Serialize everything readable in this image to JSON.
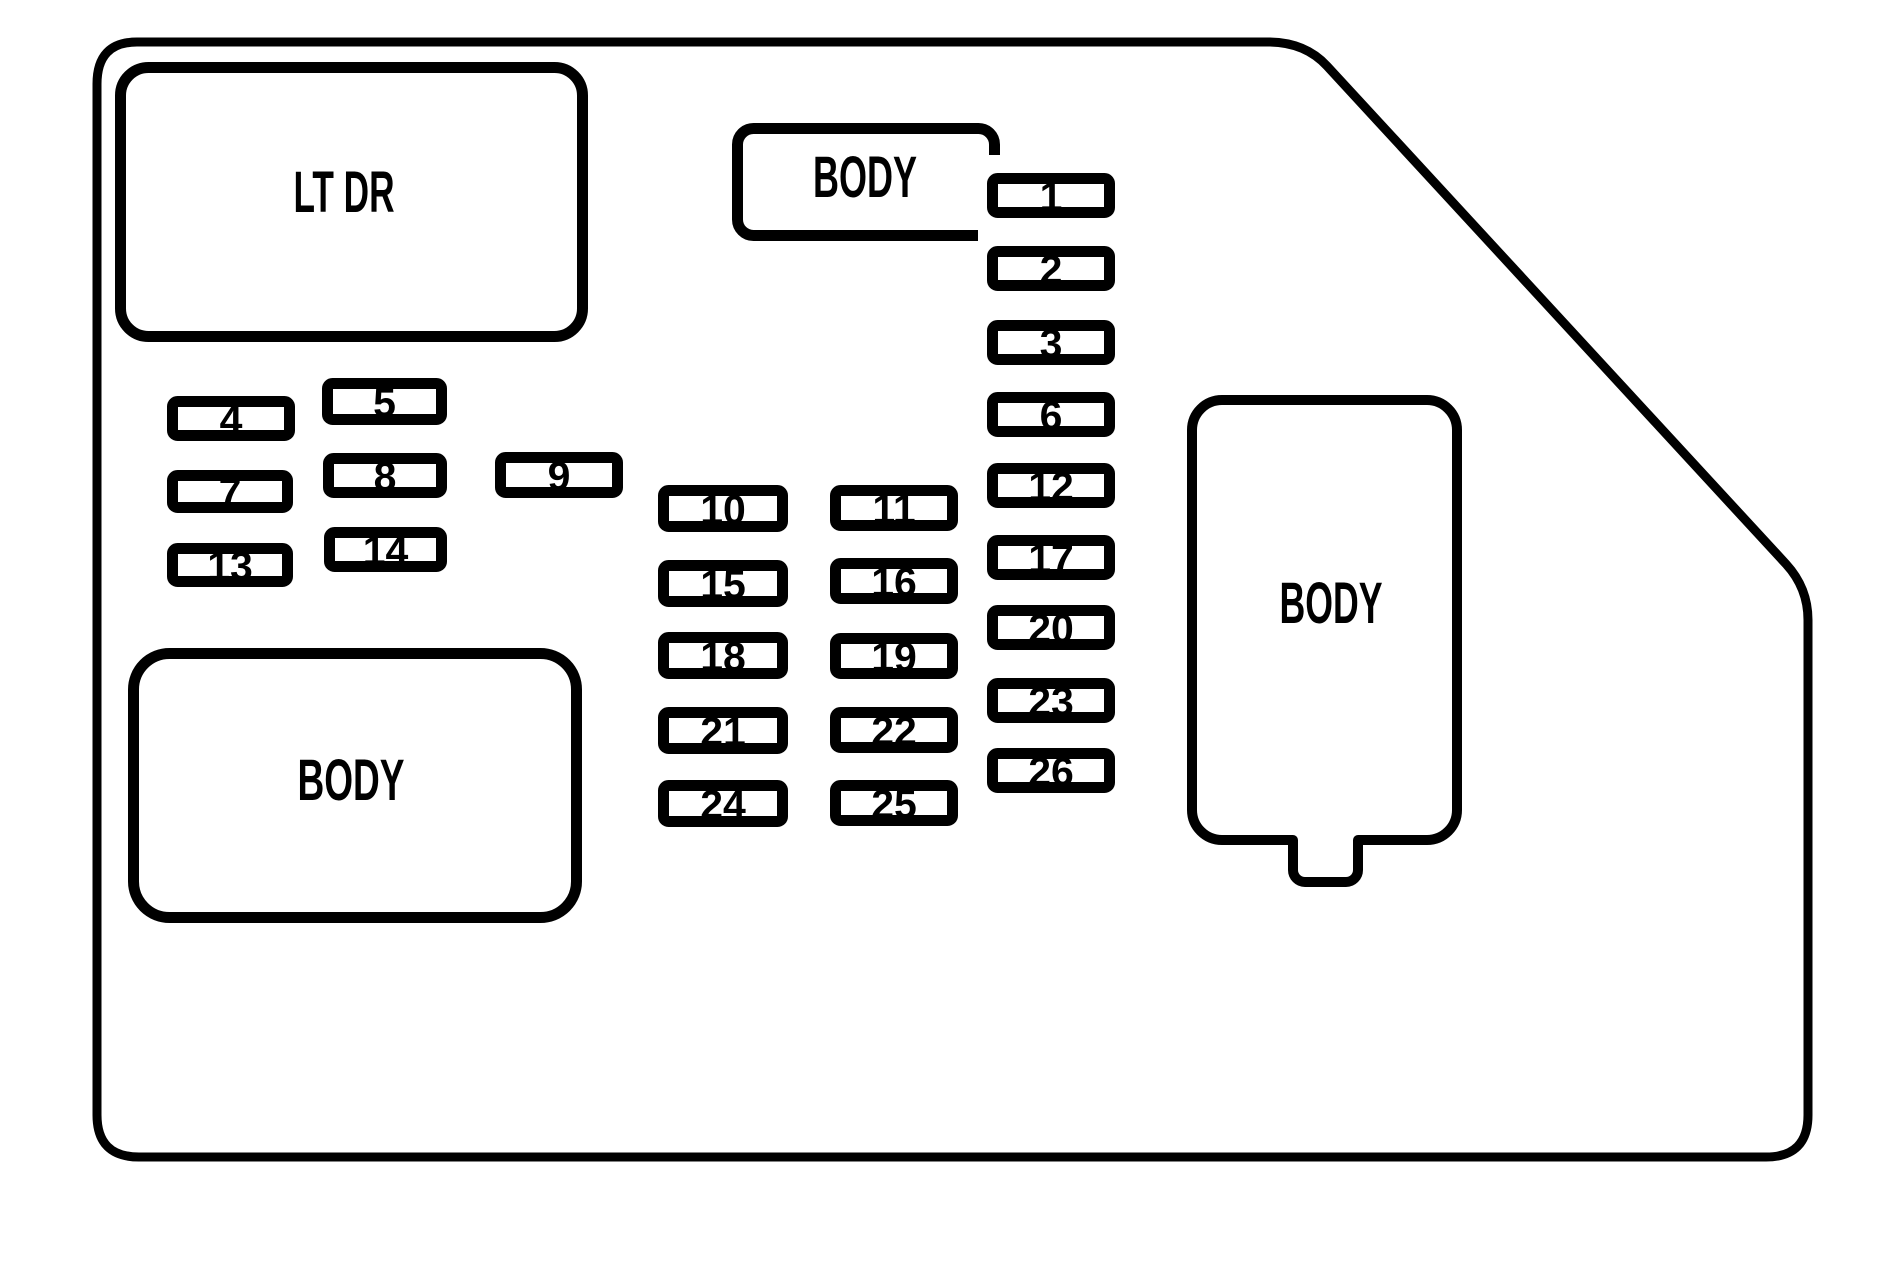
{
  "diagram": {
    "type": "fuse-box-diagram",
    "background_color": "#ffffff",
    "line_color": "#000000",
    "blocks": {
      "top_left_label": "LT DR",
      "top_middle_label": "BODY",
      "bottom_left_label": "BODY",
      "right_label": "BODY"
    },
    "fuses": {
      "right_column": [
        "1",
        "2",
        "3",
        "6",
        "12",
        "17",
        "20",
        "23",
        "26"
      ],
      "left_cluster": [
        "4",
        "5",
        "7",
        "8",
        "9",
        "13",
        "14"
      ],
      "middle_left_column": [
        "10",
        "15",
        "18",
        "21",
        "24"
      ],
      "middle_right_column": [
        "11",
        "16",
        "19",
        "22",
        "25"
      ]
    }
  }
}
